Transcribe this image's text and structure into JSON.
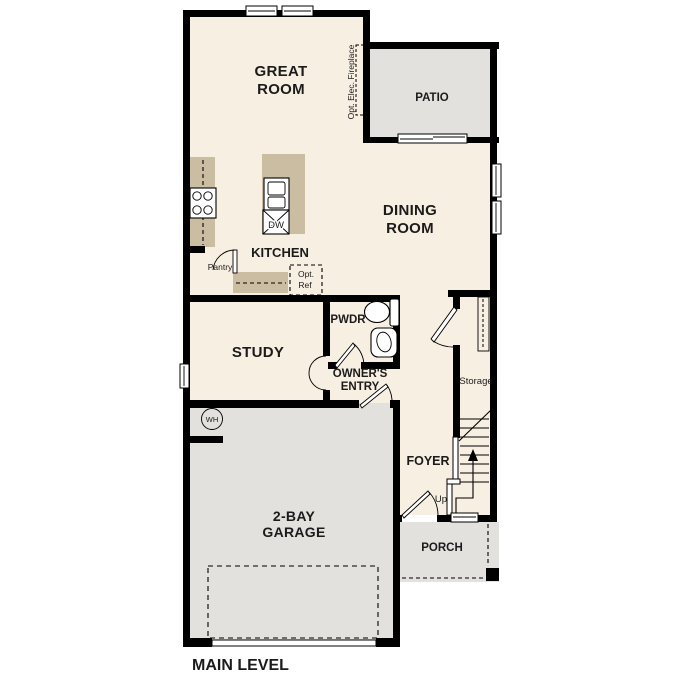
{
  "title": "MAIN LEVEL",
  "colors": {
    "floor": "#f7efe2",
    "hardscape": "#e2e1de",
    "cabinet": "#cbbda2",
    "appliance": "#dddcd9",
    "sink_fill": "#a9c7e3",
    "wall": "#000000",
    "text": "#1b1b1b"
  },
  "rooms": {
    "great_room": {
      "label_line1": "GREAT",
      "label_line2": "ROOM"
    },
    "patio": {
      "label": "PATIO"
    },
    "kitchen": {
      "label": "KITCHEN"
    },
    "dining_room": {
      "label_line1": "DINING",
      "label_line2": "ROOM"
    },
    "study": {
      "label": "STUDY"
    },
    "powder_room": {
      "label": "PWDR"
    },
    "owners_entry": {
      "label_line1": "OWNER'S",
      "label_line2": "ENTRY"
    },
    "foyer": {
      "label": "FOYER"
    },
    "storage": {
      "label": "Storage"
    },
    "garage": {
      "label_line1": "2-BAY",
      "label_line2": "GARAGE"
    },
    "porch": {
      "label": "PORCH"
    }
  },
  "annotations": {
    "optional_fireplace": "Opt. Elec. Fireplace",
    "pantry": "Pantry",
    "optional_fridge_line1": "Opt.",
    "optional_fridge_line2": "Ref",
    "dishwasher": "DW",
    "water_heater": "WH",
    "stairs_up": "Up"
  }
}
